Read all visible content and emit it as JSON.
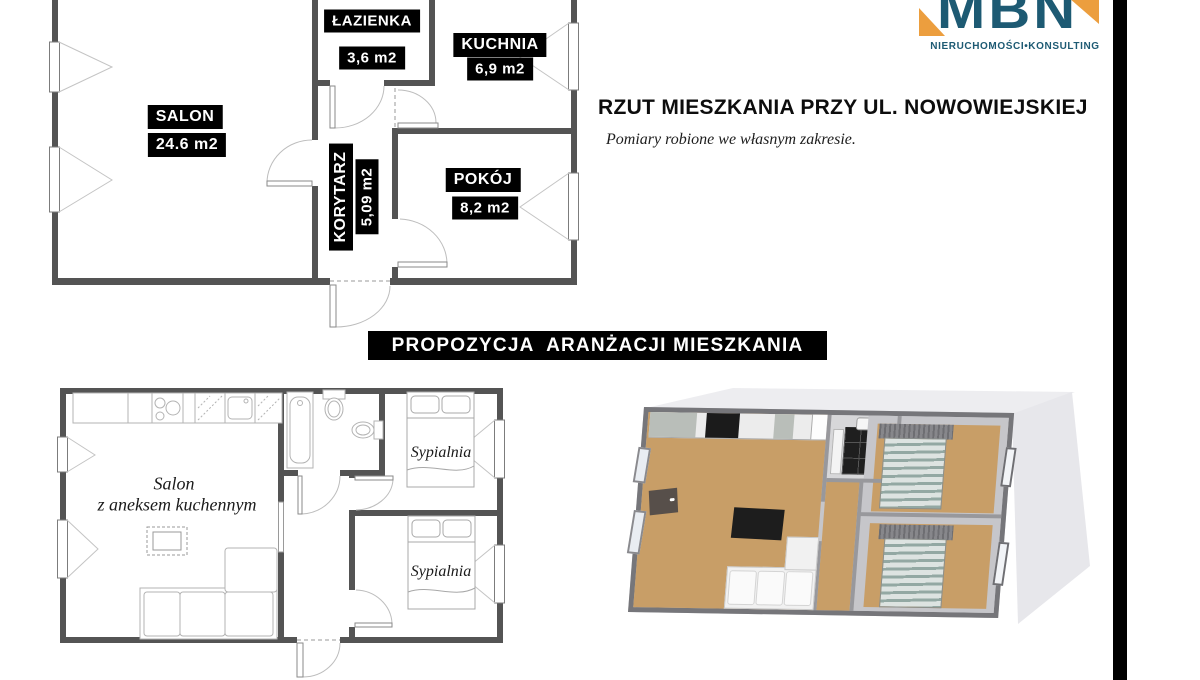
{
  "header": {
    "title": "RZUT MIESZKANIA PRZY UL. NOWOWIEJSKIEJ",
    "subtitle": "Pomiary robione we własnym zakresie.",
    "logo": {
      "text": "MBN",
      "tagline": "NIERUCHOMOŚCI•KONSULTING",
      "teal": "#1d5a73",
      "orange": "#ec9e3e"
    }
  },
  "banner": {
    "label": "PROPOZYCJA  ARANŻACJI MIESZKANIA",
    "bg": "#000000",
    "fg": "#ffffff"
  },
  "plan_top": {
    "rooms": [
      {
        "name": "SALON",
        "area": "24.6 m2"
      },
      {
        "name": "ŁAZIENKA",
        "area": "3,6 m2"
      },
      {
        "name": "KUCHNIA",
        "area": "6,9 m2"
      },
      {
        "name": "KORYTARZ",
        "area": "5,09 m2"
      },
      {
        "name": "POKÓJ",
        "area": "8,2 m2"
      }
    ],
    "wall_color": "#545454",
    "label_bg": "#000000",
    "label_fg": "#ffffff"
  },
  "plan_bottom": {
    "salon_line1": "Salon",
    "salon_line2": "z aneksem kuchennym",
    "bedroom_label": "Sypialnia",
    "wall_color": "#545454"
  },
  "plan_3d": {
    "floor_color": "#c89e67",
    "wall_color": "#c6c6ca",
    "slab_color": "#ededf0",
    "tile_color": "#1f1f1f"
  }
}
